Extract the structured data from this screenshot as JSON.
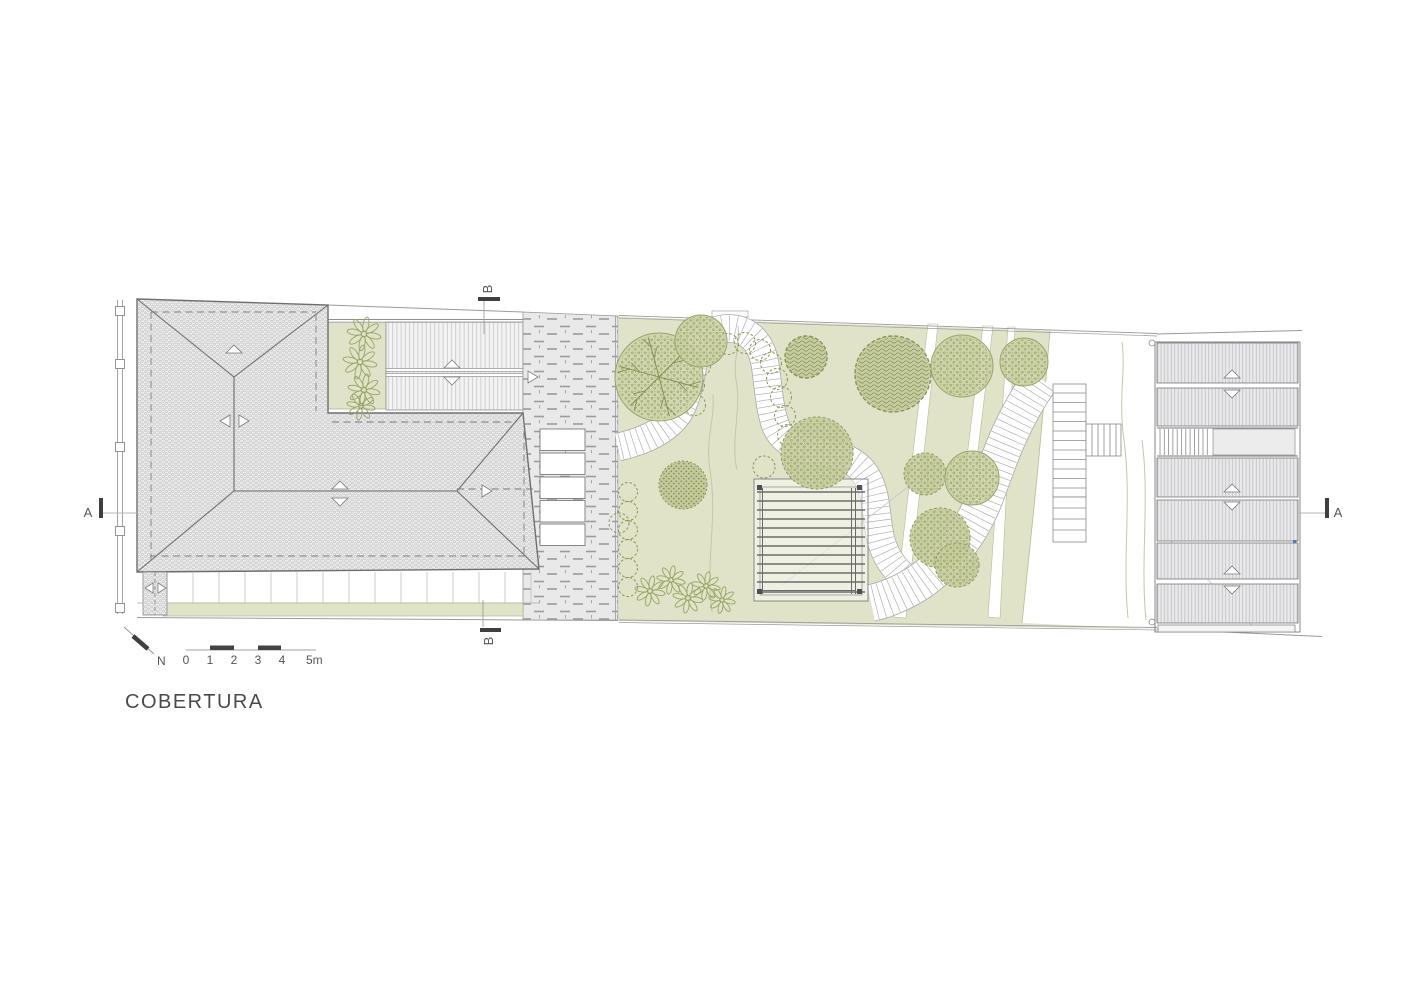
{
  "document": {
    "title": "COBERTURA"
  },
  "north": {
    "label": "N"
  },
  "scale_bar": {
    "labels": [
      "0",
      "1",
      "2",
      "3",
      "4",
      "5m"
    ]
  },
  "section_markers": {
    "a_left": "A",
    "a_right": "A",
    "b_top": "B",
    "b_bottom": "B"
  },
  "colors": {
    "garden_green": "#e0e3c8",
    "foliage_fill": "#cbd0a2",
    "foliage_stroke": "#8e9a5e",
    "line_gray": "#8c8c8c",
    "panel_gray": "#e9e9eb",
    "paver_gray": "#e9e9e9",
    "title_gray": "#4a4a4a"
  },
  "plan": {
    "ribbons": [
      {
        "d": "M618,447 C645,441 666,431 678,414 C688,399 690,377 695,356 C700,336 717,326 735,329 C752,332 762,346 765,364 C768,383 769,406 775,424 C781,441 798,450 820,452 C843,454 860,463 868,479 C876,494 876,512 879,530 C882,552 893,570 912,583",
        "w": 27
      },
      {
        "d": "M1041,379 C1014,417 1001,453 987,492 C974,528 952,560 918,583 C902,593 886,600 871,603",
        "w": 36
      }
    ],
    "trees": [
      {
        "x": 659,
        "y": 377,
        "r": 44,
        "style": "star"
      },
      {
        "x": 701,
        "y": 341,
        "r": 26,
        "style": "speckle"
      },
      {
        "x": 806,
        "y": 357,
        "r": 21,
        "style": "maze"
      },
      {
        "x": 893,
        "y": 374,
        "r": 38,
        "style": "maze"
      },
      {
        "x": 962,
        "y": 366,
        "r": 31,
        "style": "speckle"
      },
      {
        "x": 1024,
        "y": 362,
        "r": 24,
        "style": "speckle"
      },
      {
        "x": 817,
        "y": 453,
        "r": 36,
        "style": "fluffy"
      },
      {
        "x": 925,
        "y": 474,
        "r": 21,
        "style": "fluffy"
      },
      {
        "x": 972,
        "y": 478,
        "r": 27,
        "style": "speckle"
      },
      {
        "x": 940,
        "y": 538,
        "r": 30,
        "style": "fluffy"
      },
      {
        "x": 957,
        "y": 565,
        "r": 22,
        "style": "fluffy"
      },
      {
        "x": 683,
        "y": 485,
        "r": 24,
        "style": "bush"
      }
    ],
    "shrubs": [
      {
        "x": 695,
        "y": 405,
        "r": 10.5
      },
      {
        "x": 694,
        "y": 385,
        "r": 10.5
      },
      {
        "x": 700,
        "y": 366,
        "r": 10.5
      },
      {
        "x": 712,
        "y": 352,
        "r": 10.5
      },
      {
        "x": 728,
        "y": 344,
        "r": 10.5
      },
      {
        "x": 745,
        "y": 343,
        "r": 10.5
      },
      {
        "x": 760,
        "y": 350,
        "r": 10.5
      },
      {
        "x": 771,
        "y": 363,
        "r": 10.5
      },
      {
        "x": 777,
        "y": 379,
        "r": 10.5
      },
      {
        "x": 781,
        "y": 397,
        "r": 10.5
      },
      {
        "x": 785,
        "y": 416,
        "r": 10.5
      },
      {
        "x": 788,
        "y": 435,
        "r": 10.5
      },
      {
        "x": 628,
        "y": 492,
        "r": 9.5
      },
      {
        "x": 628,
        "y": 511,
        "r": 9.5
      },
      {
        "x": 628,
        "y": 530,
        "r": 9.5
      },
      {
        "x": 628,
        "y": 549,
        "r": 9.5
      },
      {
        "x": 628,
        "y": 568,
        "r": 9.5
      },
      {
        "x": 628,
        "y": 587,
        "r": 9.5
      },
      {
        "x": 764,
        "y": 467,
        "r": 11
      },
      {
        "x": 619,
        "y": 523,
        "r": 10
      }
    ],
    "flowers": [
      {
        "x": 364,
        "y": 334,
        "r": 19
      },
      {
        "x": 360,
        "y": 362,
        "r": 19
      },
      {
        "x": 364,
        "y": 390,
        "r": 18
      },
      {
        "x": 361,
        "y": 406,
        "r": 16
      },
      {
        "x": 650,
        "y": 591,
        "r": 17
      },
      {
        "x": 671,
        "y": 580,
        "r": 16
      },
      {
        "x": 688,
        "y": 598,
        "r": 17
      },
      {
        "x": 706,
        "y": 586,
        "r": 16
      },
      {
        "x": 722,
        "y": 600,
        "r": 15
      }
    ]
  }
}
